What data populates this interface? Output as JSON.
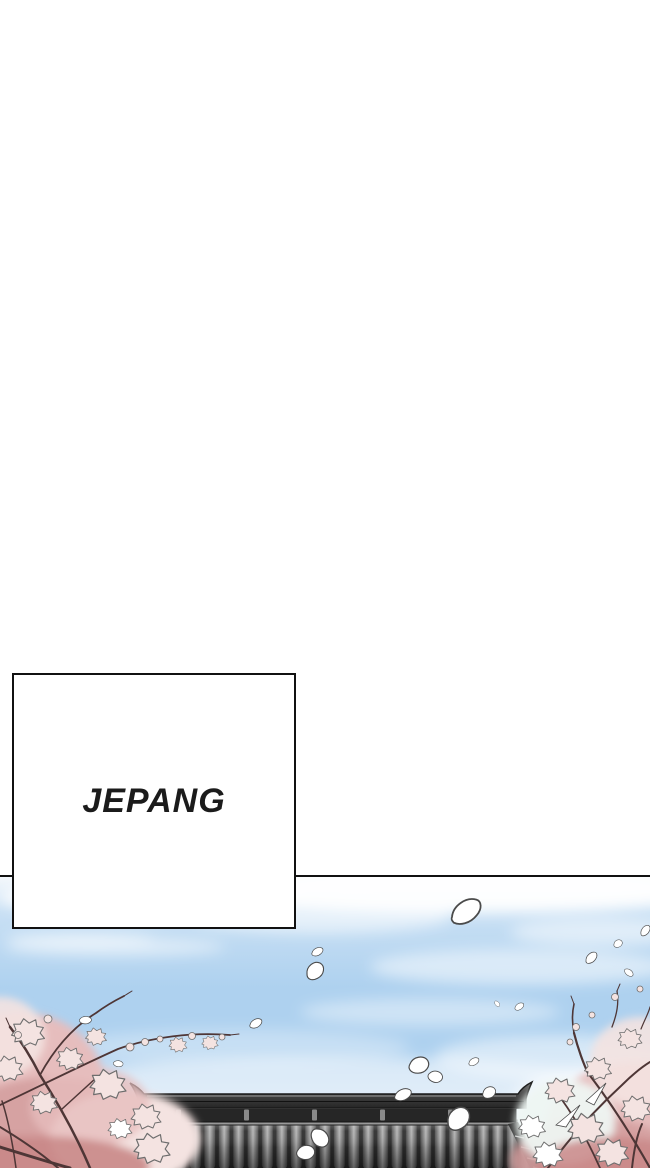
{
  "caption": {
    "label": "JEPANG"
  },
  "colors": {
    "page-bg": "#ffffff",
    "line": "#111111",
    "caption-text": "#1b1b1b",
    "caption-bg": "#ffffff",
    "sky-top": "#f4f8fc",
    "sky-high": "#c9e0f4",
    "sky-mid": "#aed1ef",
    "sky-low": "#c6ddf3",
    "sky-horizon": "#e7f0f9",
    "cloud": "#ffffff",
    "petal-fill": "#ffffff",
    "petal-outline": "#4b4b4b",
    "blossom-light": "#f4e3e1",
    "blossom-mid": "#e6bdbd",
    "blossom-deep": "#d49e9e",
    "blossom-rose": "#c98787",
    "floret-outline": "#6e6e6e",
    "branch": "#4e3636",
    "ridge-light": "#757575",
    "ridge-dark": "#262626",
    "roof-outline": "#1a1a1a",
    "tile-light": "#b4b4b4",
    "tile-dark": "#4f4f4f",
    "tile-gap": "#2e2e2e"
  }
}
